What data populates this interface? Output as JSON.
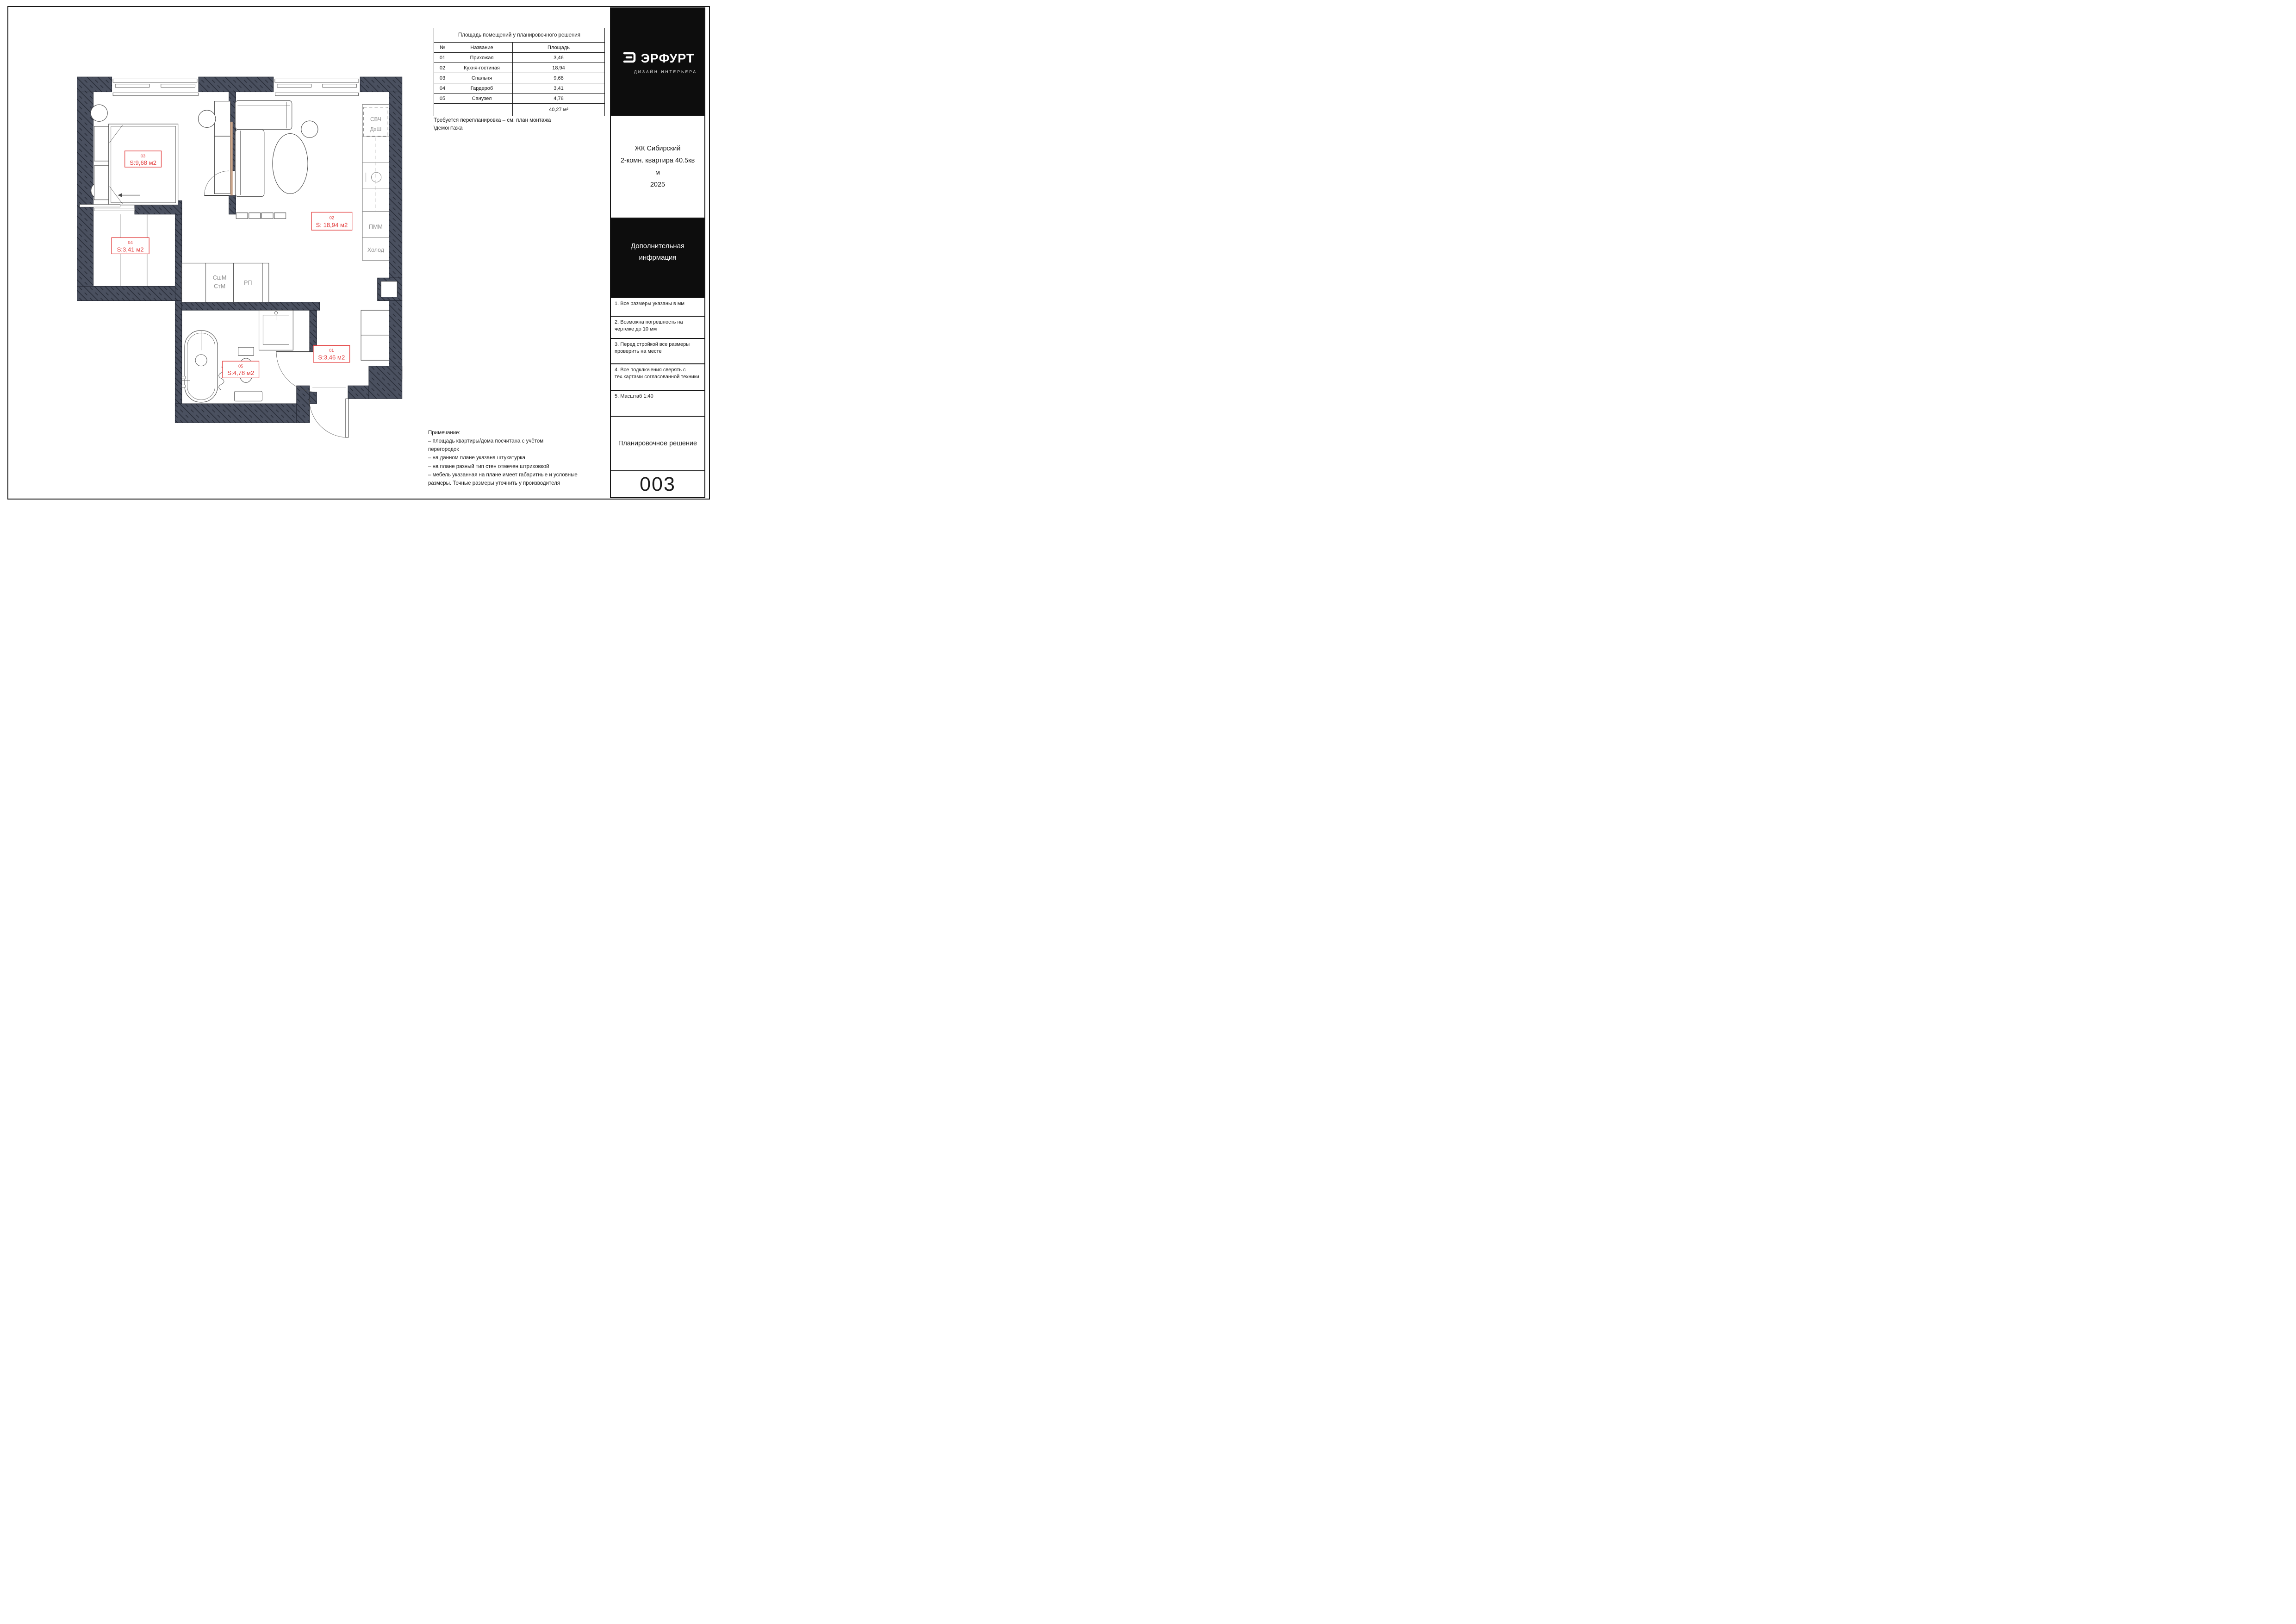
{
  "sheet": {
    "area_table": {
      "title": "Площадь помещений у планировочного решения",
      "headers": {
        "num": "№",
        "name": "Название",
        "area": "Площадь"
      },
      "rows": [
        {
          "num": "01",
          "name": "Прихожая",
          "area": "3,46"
        },
        {
          "num": "02",
          "name": "Кухня-гостиная",
          "area": "18,94"
        },
        {
          "num": "03",
          "name": "Спальня",
          "area": "9,68"
        },
        {
          "num": "04",
          "name": "Гардероб",
          "area": "3,41"
        },
        {
          "num": "05",
          "name": "Санузел",
          "area": "4,78"
        }
      ],
      "total": "40,27 м²"
    },
    "remark": {
      "line1": "Требуется перепланировка – см. план монтажа",
      "line2": "\\демонтажа"
    },
    "note": {
      "title": "Примечание:",
      "lines": [
        "– площадь квартиры/дома посчитана с учётом",
        "перегородок",
        "– на данном плане указана штукатурка",
        "– на плане разный тип стен отмечен штриховкой",
        "– мебель указанная на плане имеет габаритные и условные",
        "размеры. Точные размеры уточнить у производителя"
      ]
    },
    "titleblock": {
      "brand": {
        "name": "ЭРФУРТ",
        "tagline": "ДИЗАЙН ИНТЕРЬЕРА"
      },
      "project": {
        "line1": "ЖК Сибирский",
        "line2": "2-комн. квартира 40.5кв",
        "line3": "м",
        "line4": "2025"
      },
      "extra": {
        "line1": "Дополнительная",
        "line2": "инфрмация"
      },
      "notes": [
        "1. Все размеры указаны в мм",
        "2. Возможна погрешность на чертеже до 10 мм",
        "3. Перед стройкой все размеры проверить на месте",
        "4. Все подключения сверять с тех.картами согласованной техники",
        "5. Масштаб 1:40"
      ],
      "doc_title": "Планировочное решение",
      "sheet_number": "003"
    },
    "plan": {
      "rooms": [
        {
          "num": "03",
          "area": "S:9,68 м2"
        },
        {
          "num": "02",
          "area": "S: 18,94 м2"
        },
        {
          "num": "04",
          "area": "S:3,41 м2"
        },
        {
          "num": "05",
          "area": "S:4,78 м2"
        },
        {
          "num": "01",
          "area": "S:3,46 м2"
        }
      ],
      "labels": {
        "svch": "СВЧ",
        "dhsh": "ДхШ",
        "pmm": "ПММ",
        "holod": "Холод",
        "sshm": "СшМ",
        "stm": "СтМ",
        "rp": "РП"
      }
    },
    "colors": {
      "wall": "#4a505f",
      "accent": "#e23b3b",
      "wood": "#c9a489"
    }
  }
}
